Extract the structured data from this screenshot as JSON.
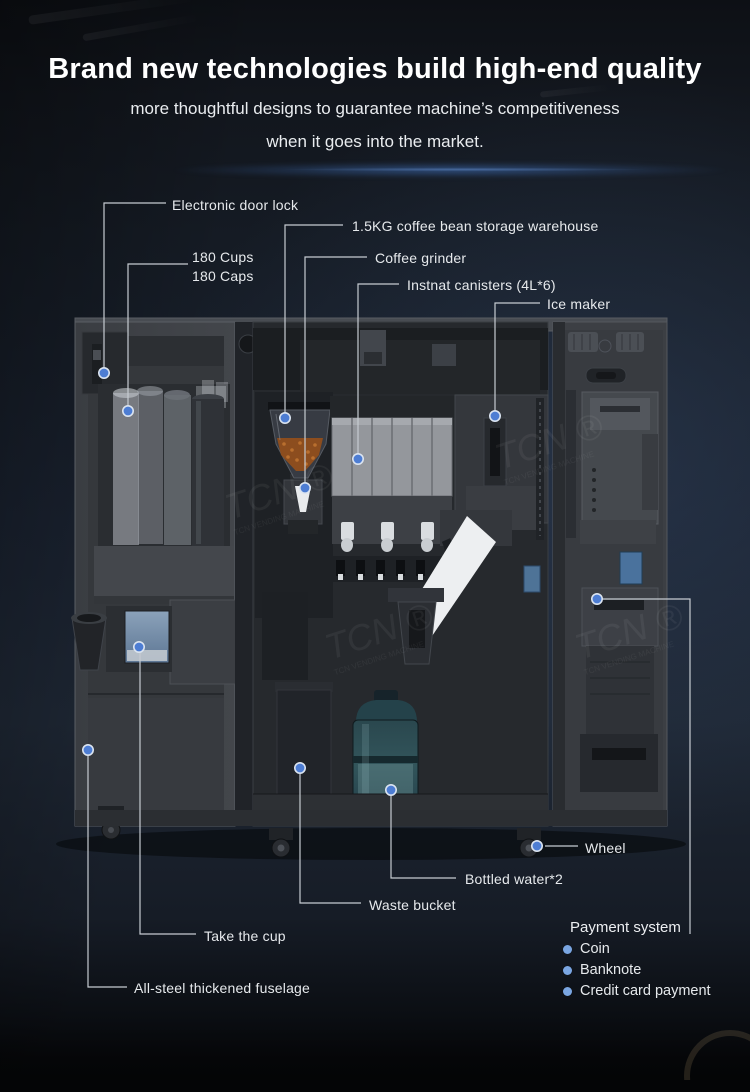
{
  "header": {
    "title": "Brand new technologies build high-end quality",
    "subtitle_line1": "more thoughtful designs to guarantee machine’s competitiveness",
    "subtitle_line2": "when it goes into the market."
  },
  "labels": {
    "door_lock": "Electronic door lock",
    "cups": "180 Cups",
    "caps": "180 Caps",
    "bean_storage": "1.5KG coffee bean storage warehouse",
    "grinder": "Coffee grinder",
    "canisters": "Instnat canisters (4L*6)",
    "ice_maker": "Ice maker",
    "wheel": "Wheel",
    "bottled_water": "Bottled water*2",
    "waste_bucket": "Waste bucket",
    "take_cup": "Take the cup",
    "fuselage": "All-steel thickened fuselage"
  },
  "payment": {
    "title": "Payment system",
    "items": [
      "Coin",
      "Banknote",
      "Credit card payment"
    ]
  },
  "watermark": {
    "logo": "TCN ®",
    "sub": "TCN VENDING MACHINE"
  },
  "colors": {
    "background_top": "#10141a",
    "background_mid": "#1c2530",
    "accent_dot": "#4d7dd3",
    "callout_line": "#c6cbd1",
    "payment_bullet": "#7aa6e2",
    "glow_blue": "#3a70c8",
    "title_text": "#ffffff",
    "label_text": "#e6e9ec"
  }
}
